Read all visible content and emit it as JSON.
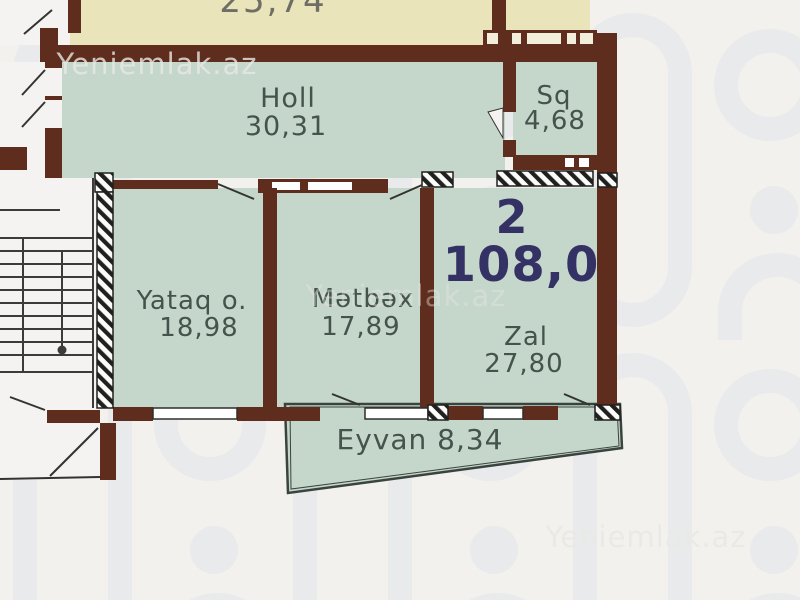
{
  "watermark": {
    "text": "Yeniemlak.az"
  },
  "apartment": {
    "number": "2",
    "total_area": "108,0"
  },
  "rooms": {
    "holl": {
      "name": "Holl",
      "area": "30,31"
    },
    "sq": {
      "name": "Sq",
      "area": "4,68"
    },
    "yataq": {
      "name": "Yataq o.",
      "area": "18,98"
    },
    "metbex": {
      "name": "Mətbəx",
      "area": "17,89"
    },
    "zal": {
      "name": "Zal",
      "area": "27,80"
    },
    "eyvan": {
      "label": "Eyvan 8,34"
    },
    "upper_cut": {
      "area": "25,74"
    }
  },
  "colors": {
    "background": "#f2f1ee",
    "pattern": "#e2e5e9",
    "wall": "#5e2d1e",
    "room_fill": "#c5d6cb",
    "upper_room_fill": "#e9e4ba",
    "room_text": "#44544c",
    "apartment_text": "#343165"
  }
}
